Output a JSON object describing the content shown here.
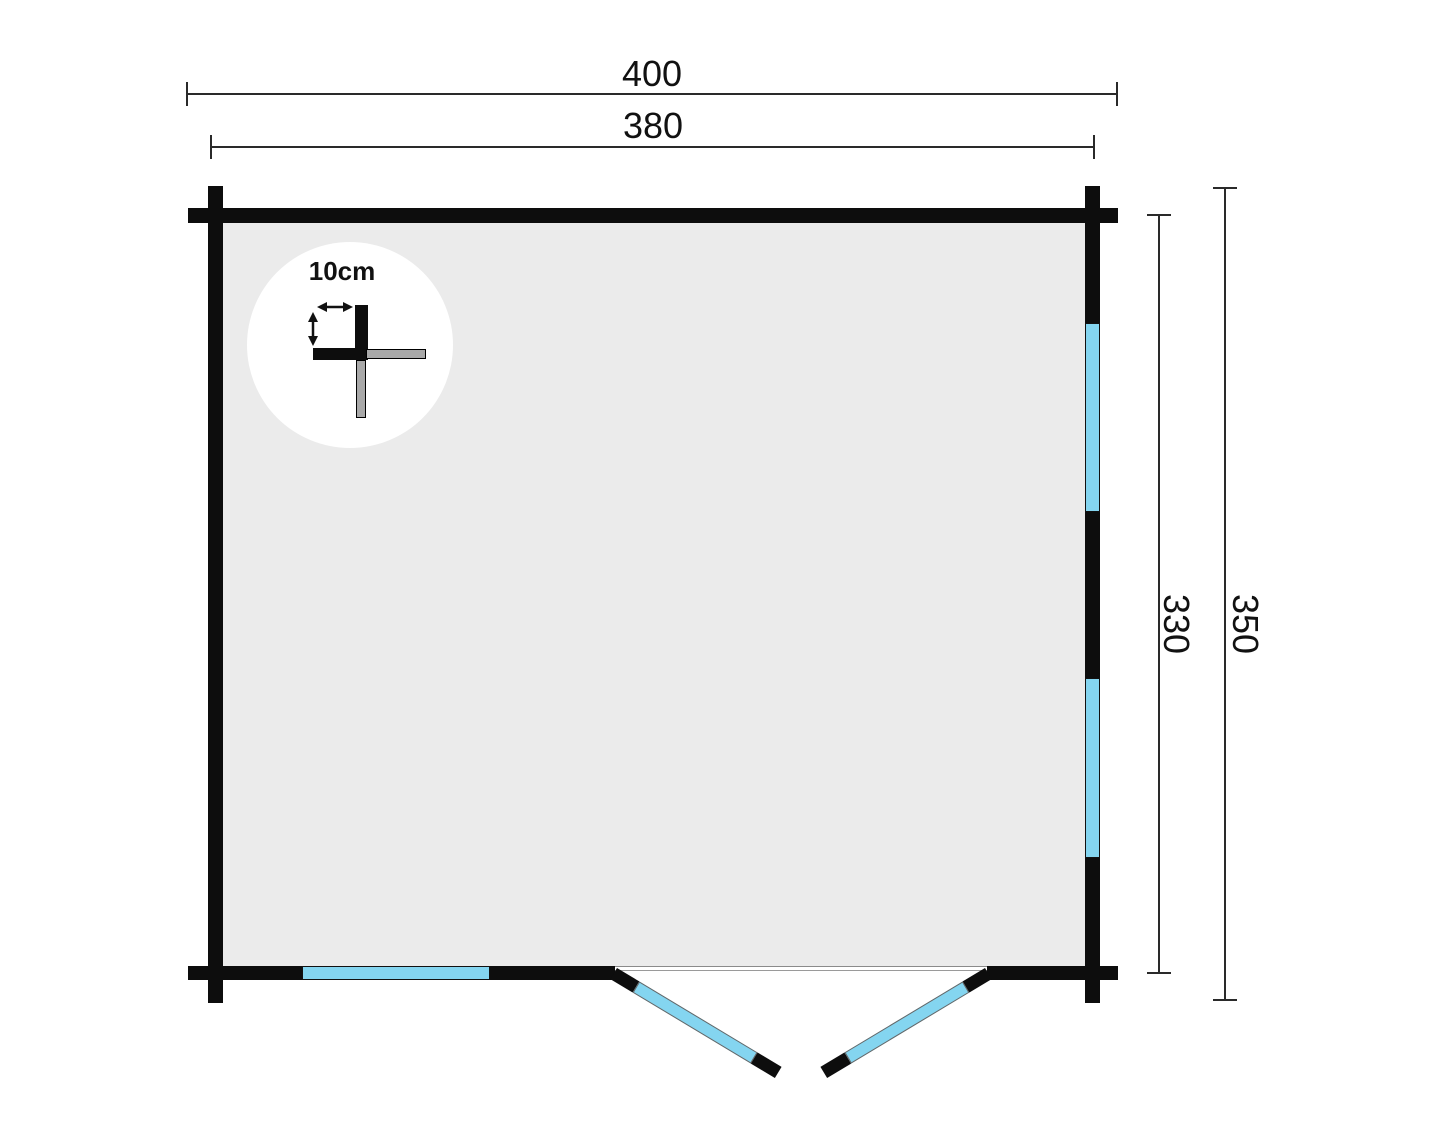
{
  "diagram": {
    "type": "floor-plan",
    "dimensions": {
      "outer_width": "400",
      "inner_width": "380",
      "inner_depth": "330",
      "outer_depth": "350"
    },
    "detail": {
      "log_thickness_label": "10cm"
    },
    "colors": {
      "wall": "#0d0d0d",
      "interior": "#ebebeb",
      "window": "#84d5f0",
      "log_cut_gray": "#a9a9a9"
    }
  }
}
